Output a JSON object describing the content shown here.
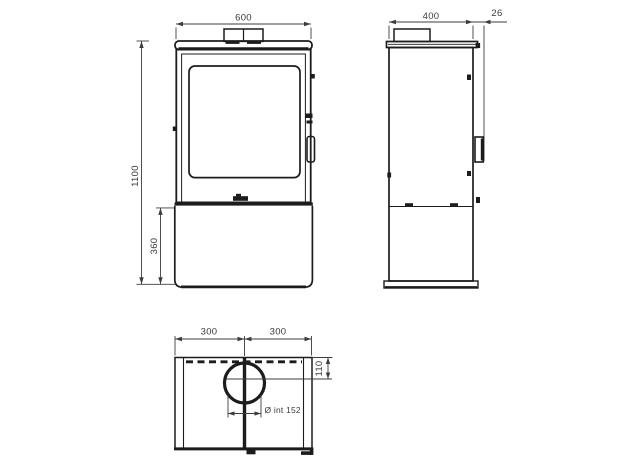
{
  "dimensions": {
    "front_width": "600",
    "front_height": "1100",
    "front_base_height": "360",
    "side_depth": "400",
    "side_handle_offset": "26",
    "top_half_left": "300",
    "top_half_right": "300",
    "top_flue_offset": "110",
    "top_flue_diameter": "Ø int 152"
  },
  "colors": {
    "line": "#1c1c1c",
    "dimension": "#3d3d3d",
    "background": "#ffffff"
  }
}
